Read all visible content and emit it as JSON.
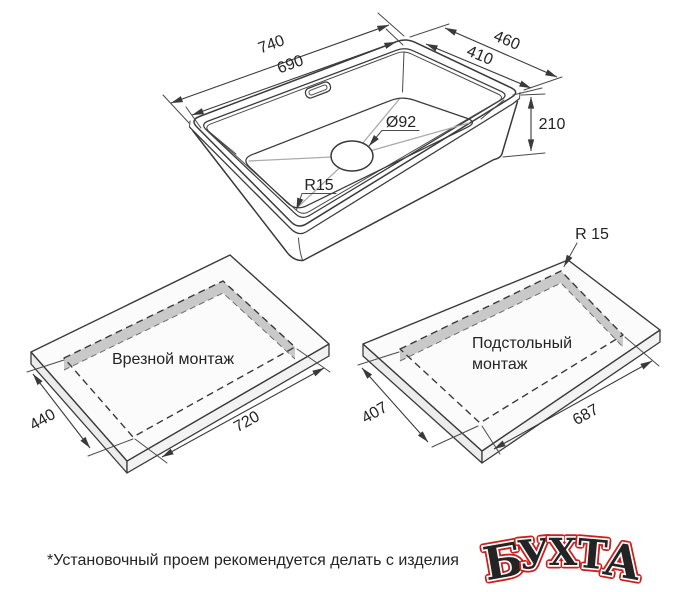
{
  "sink_view": {
    "dim_outer_length": "740",
    "dim_inner_length": "690",
    "dim_outer_width": "460",
    "dim_inner_width": "410",
    "dim_height": "210",
    "dim_drain": "Ø92",
    "dim_corner_radius": "R15"
  },
  "inset_mount": {
    "label": "Врезной монтаж",
    "dim_width": "440",
    "dim_length": "720"
  },
  "undermount": {
    "label_line1": "Подстольный",
    "label_line2": "монтаж",
    "dim_width": "407",
    "dim_length": "687",
    "dim_corner_radius": "R 15"
  },
  "footer_note": "*Установочный проем рекомендуется делать с изделия",
  "logo": {
    "text": "БУХТА",
    "letters": [
      "Б",
      "У",
      "Х",
      "Т",
      "А"
    ],
    "color": "#cf1f1c",
    "outline_color": "#ffffff"
  },
  "colors": {
    "line": "#3a3a3a",
    "light_line": "#ababab",
    "cutout_wall": "#c9c9c9",
    "slab_side": "#ececec",
    "slab_top": "#fbfbfb"
  }
}
